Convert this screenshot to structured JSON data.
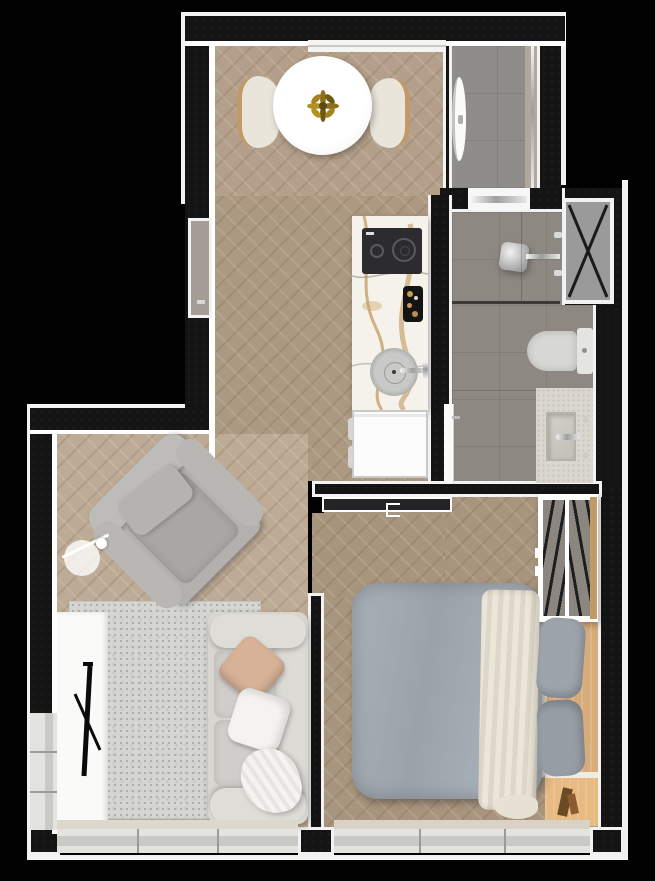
{
  "scene": {
    "kind": "apartment-floor-plan",
    "view": "top-down 3d render",
    "width_px": 655,
    "height_px": 881
  },
  "colors": {
    "background": "#020202",
    "wall": "#141414",
    "trim": "#f2f2f2",
    "wood_dining": "#b4a08a",
    "wood_corridor": "#ac9982",
    "wood_living": "#bdab95",
    "wood_bedroom": "#a8957e",
    "tile_bath": "#8e8882",
    "tile_hall": "#8e8d89",
    "hall_strip": "#b1a89b",
    "rug": "#d5d5d1",
    "sofa": "#d7d6d1",
    "armchair": "#b2b1ae",
    "duvet": "#a1a9b1",
    "blanket": "#e7e1d3",
    "pillow_gray": "#9da4ac",
    "pillow_tan": "#d8b297",
    "throw_white": "#f4f3f0",
    "marble": "#f5f2ec",
    "marble_vein": "#b8914f",
    "cooktop": "#2c2c2e",
    "fridge": "#fcfcfc",
    "console": "#fafaf9",
    "headboard": "#d7ac7a",
    "nightstand": "#e6ba81",
    "closet_wood": "#c19a66",
    "shaft": "#8b8680",
    "toilet": "#d7d7d4",
    "vanity": "#dad7d0",
    "sill": "#e3e3e0",
    "sill_band": "#c9c9c6",
    "glass_line": "#3c3a37",
    "niche": "#a39d95"
  },
  "rooms": [
    {
      "name": "Dining area"
    },
    {
      "name": "Kitchen"
    },
    {
      "name": "Entry hall"
    },
    {
      "name": "Bathroom"
    },
    {
      "name": "Living area"
    },
    {
      "name": "Bedroom"
    },
    {
      "name": "Corridor"
    }
  ],
  "labels": {
    "dining_table": "Round dining table",
    "dining_chair_left": "Dining chair",
    "dining_chair_right": "Dining chair",
    "plant": "Table centerpiece plant",
    "counter": "Kitchen counter (marble)",
    "cooktop": "Two-burner cooktop",
    "sink": "Kitchen sink",
    "fridge": "Refrigerator",
    "tray": "Serving tray",
    "shower": "Shower head",
    "glass": "Shower glass partition",
    "toilet": "Toilet",
    "vanity": "Bathroom vanity sink",
    "shaft": "Ventilation shaft",
    "wardrobe": "Wardrobe with hangers",
    "bed": "Double bed",
    "blanket": "Throw blanket",
    "pillows": "Bed pillows",
    "headboard": "Wood headboard panel",
    "nightstand": "Wood nightstand",
    "armchair": "Armchair",
    "lamp": "Floor lamp",
    "rug": "Area rug",
    "sofa": "Sofa",
    "tv_console": "TV console",
    "tv": "Television (edge view)",
    "window": "Window",
    "entry_door": "Entry door",
    "bath_door": "Bathroom door",
    "sliding_door": "Bedroom sliding door"
  }
}
